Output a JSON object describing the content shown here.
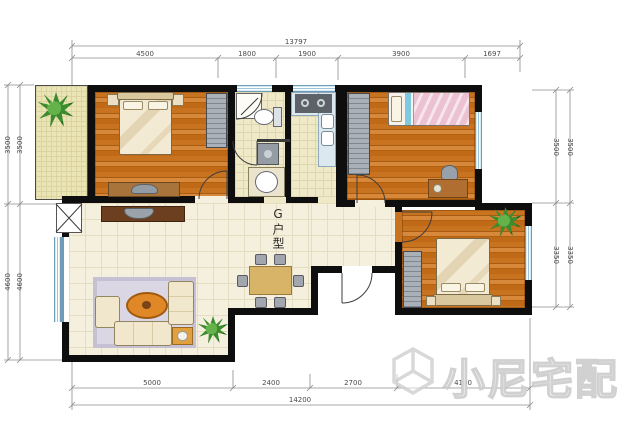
{
  "unit_label": "G户型",
  "watermark": {
    "brand": "小尼宅配"
  },
  "dims": {
    "top": {
      "overall": "13797",
      "segments": [
        "4500",
        "1800",
        "1900",
        "3900",
        "1697"
      ]
    },
    "bottom": {
      "overall": "14200",
      "segments": [
        "5000",
        "2400",
        "2700",
        "4100"
      ]
    },
    "left": {
      "segments": [
        "3500",
        "4600"
      ]
    },
    "right": {
      "segments": [
        "3500",
        "3350"
      ]
    }
  },
  "colors": {
    "wall": "#0e0e0e",
    "wood_floor": "#c06a18",
    "tile_floor": "#f5f0dd",
    "balcony": "#ebe4b4",
    "window": "#b9d8ea",
    "plant": "#3c8c2e"
  }
}
